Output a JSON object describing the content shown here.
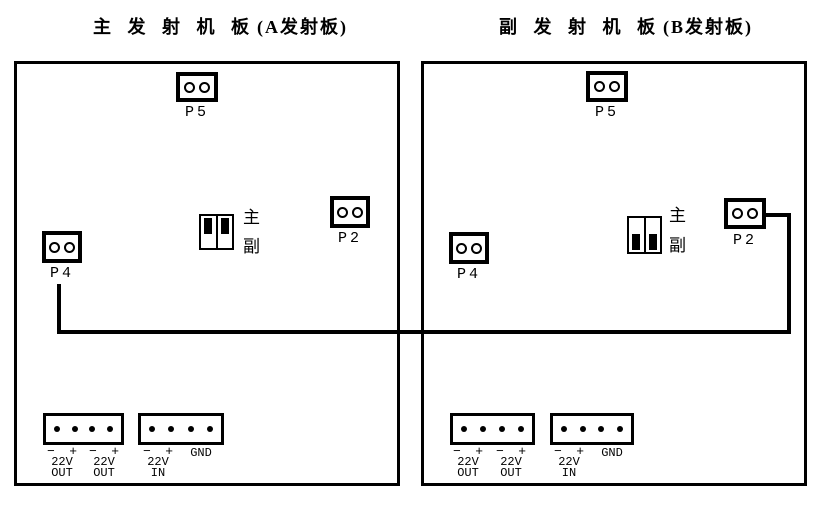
{
  "diagram": {
    "background": "#ffffff",
    "line_color": "#000000",
    "boards": [
      {
        "id": "A",
        "title_main": "主 发 射 机 板",
        "title_paren": "(A发射板)",
        "p5": "P5",
        "p2": "P2",
        "p4": "P4",
        "jumper": {
          "main": "主",
          "sub": "副",
          "selected": "主"
        }
      },
      {
        "id": "B",
        "title_main": "副 发 射 机 板",
        "title_paren": "(B发射板)",
        "p5": "P5",
        "p2": "P2",
        "p4": "P4",
        "jumper": {
          "main": "主",
          "sub": "副",
          "selected": "副"
        }
      }
    ],
    "power": {
      "minus": "−",
      "plus": "+",
      "volt": "22V",
      "out": "OUT",
      "in": "IN",
      "gnd": "GND"
    }
  }
}
